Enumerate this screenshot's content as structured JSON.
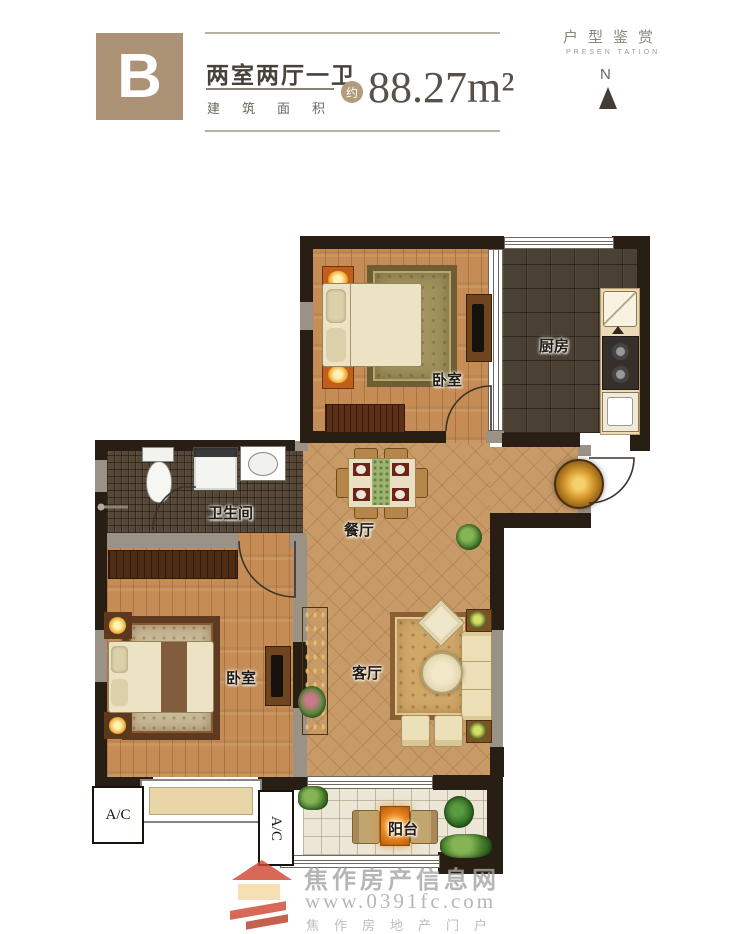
{
  "header": {
    "unit_label": "B",
    "title": "两室两厅一卫",
    "area_label": "建筑面积",
    "area_prefix": "约",
    "area_value": "88.27m²",
    "brand_title": "户型鉴赏",
    "brand_subtitle": "PRESEN TATION",
    "compass_label": "N"
  },
  "rooms": {
    "bedroom_top": "卧室",
    "kitchen": "厨房",
    "bathroom": "卫生间",
    "dining": "餐厅",
    "living": "客厅",
    "bedroom_bottom": "卧室",
    "balcony": "阳台"
  },
  "annotations": {
    "ac_left": "A/C",
    "ac_balcony": "A/C"
  },
  "watermark": {
    "site_name": "焦作房产信息网",
    "site_url": "www.0391fc.com",
    "tagline": "焦作房地产门户"
  },
  "colors": {
    "badge": "#ac9274",
    "wall": "#281e13",
    "graywall": "#9a9187",
    "wood": "#c58d55",
    "tile": "#c89a68",
    "kitchen_floor": "#4b4034",
    "mosaic": "#554838",
    "balcony_floor": "#ebe6d6",
    "accent_orange": "#e8831d"
  }
}
